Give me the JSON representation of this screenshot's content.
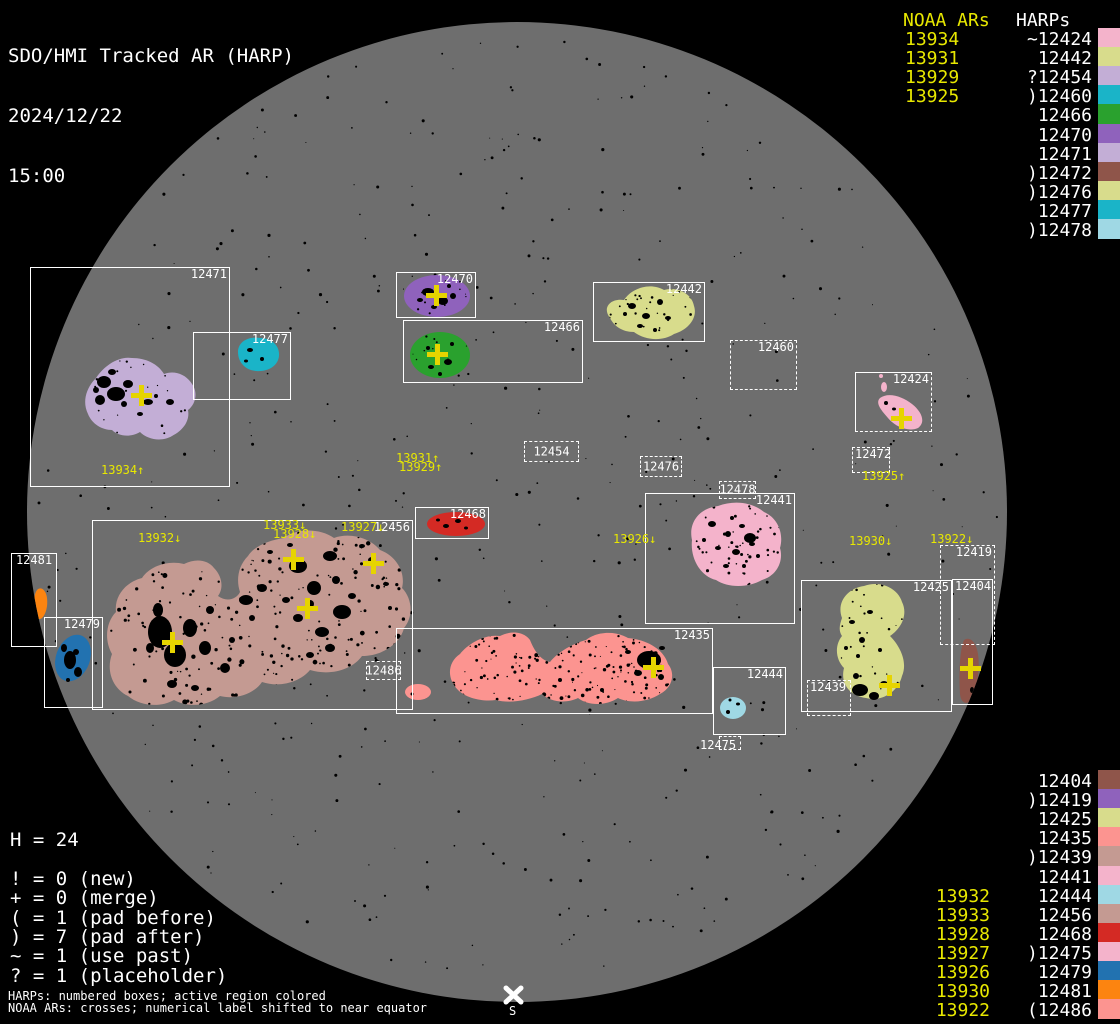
{
  "title": {
    "app": "SDO/HMI Tracked AR (HARP)",
    "date": "2024/12/22",
    "time": "15:00"
  },
  "palette": {
    "background": "#000000",
    "disk": "#6e6e6e",
    "box_line": "#ffffff",
    "text_white": "#ffffff",
    "noaa_yellow": "#e8e800",
    "cross_yellow": "#e6d400"
  },
  "harp_colors": {
    "12404": "#8f554a",
    "12419": "#8f62bc",
    "12424": "#f4b3cb",
    "12425": "#d8dc8c",
    "12435": "#fc9490",
    "12439": "#c49a92",
    "12441": "#f4b3cb",
    "12442": "#d8dc8c",
    "12444": "#9fd8e4",
    "12454": "#c3aed6",
    "12456": "#c49a92",
    "12460": "#1ab4c8",
    "12466": "#2aa12e",
    "12468": "#d42a24",
    "12470": "#8f62bc",
    "12471": "#c3aed6",
    "12472": "#8f554a",
    "12475": "#f4b3cb",
    "12476": "#d8dc8c",
    "12477": "#1ab4c8",
    "12478": "#9fd8e4",
    "12479": "#2272b0",
    "12481": "#fc8410",
    "12486": "#fc9490"
  },
  "top_right": {
    "noaa_header": "NOAA ARs",
    "harps_header": "HARPs",
    "noaa": [
      "13934",
      "13931",
      "13929",
      "13925"
    ],
    "harps": [
      "~12424",
      "12442",
      "?12454",
      ")12460",
      "12466",
      "12470",
      "12471",
      ")12472",
      ")12476",
      "12477",
      ")12478"
    ]
  },
  "bottom_right": {
    "harps": [
      "12404",
      ")12419",
      "12425",
      "12435",
      ")12439",
      "12441",
      "12444",
      "12456",
      "12468",
      ")12475",
      "12479",
      "12481",
      "(12486"
    ],
    "noaa": [
      "13932",
      "13933",
      "13928",
      "13927",
      "13926",
      "13930",
      "13922"
    ],
    "noaa_row_offset": 6
  },
  "legend": {
    "histogram": "H = 24",
    "rows": [
      "! = 0 (new)",
      "+ = 0 (merge)",
      "( = 1 (pad before)",
      ") = 7 (pad after)",
      "~ = 1 (use past)",
      "? = 1 (placeholder)"
    ]
  },
  "footer": {
    "line1": "HARPs: numbered boxes; active region colored",
    "line2": "NOAA ARs: crosses; numerical label shifted to near equator"
  },
  "south_marker": {
    "label": "S"
  },
  "boxes": [
    {
      "label": "12471",
      "x": 30,
      "y": 267,
      "w": 200,
      "h": 220,
      "style": "solid",
      "pos": "tr"
    },
    {
      "label": "12477",
      "x": 193,
      "y": 332,
      "w": 98,
      "h": 68,
      "style": "solid",
      "pos": "tr"
    },
    {
      "label": "12470",
      "x": 396,
      "y": 272,
      "w": 80,
      "h": 46,
      "style": "solid",
      "pos": "tr"
    },
    {
      "label": "12466",
      "x": 403,
      "y": 320,
      "w": 180,
      "h": 63,
      "style": "solid",
      "pos": "tr"
    },
    {
      "label": "12442",
      "x": 593,
      "y": 282,
      "w": 112,
      "h": 60,
      "style": "solid",
      "pos": "tr"
    },
    {
      "label": "12460",
      "x": 730,
      "y": 340,
      "w": 67,
      "h": 50,
      "style": "dotted",
      "pos": "tr"
    },
    {
      "label": "12424",
      "x": 855,
      "y": 372,
      "w": 77,
      "h": 60,
      "style": "mixed",
      "pos": "tr"
    },
    {
      "label": "12472",
      "x": 852,
      "y": 447,
      "w": 38,
      "h": 26,
      "style": "dotted",
      "pos": "tl"
    },
    {
      "label": "12454",
      "x": 524,
      "y": 441,
      "w": 55,
      "h": 21,
      "style": "dotted",
      "pos": "c"
    },
    {
      "label": "12476",
      "x": 640,
      "y": 456,
      "w": 42,
      "h": 21,
      "style": "dotted",
      "pos": "c"
    },
    {
      "label": "12478",
      "x": 719,
      "y": 481,
      "w": 37,
      "h": 18,
      "style": "dotted",
      "pos": "c"
    },
    {
      "label": "12441",
      "x": 645,
      "y": 493,
      "w": 150,
      "h": 131,
      "style": "solid",
      "pos": "tr"
    },
    {
      "label": "12468",
      "x": 415,
      "y": 507,
      "w": 74,
      "h": 32,
      "style": "solid",
      "pos": "tr"
    },
    {
      "label": "12456",
      "x": 92,
      "y": 520,
      "w": 321,
      "h": 190,
      "style": "solid",
      "pos": "tr"
    },
    {
      "label": "12486",
      "x": 366,
      "y": 661,
      "w": 35,
      "h": 19,
      "style": "dotted",
      "pos": "c"
    },
    {
      "label": "12481",
      "x": 11,
      "y": 553,
      "w": 46,
      "h": 94,
      "style": "solid",
      "pos": "tc"
    },
    {
      "label": "12479",
      "x": 44,
      "y": 617,
      "w": 59,
      "h": 91,
      "style": "solid",
      "pos": "tr"
    },
    {
      "label": "12435",
      "x": 396,
      "y": 628,
      "w": 317,
      "h": 86,
      "style": "solid",
      "pos": "tr"
    },
    {
      "label": "12444",
      "x": 713,
      "y": 667,
      "w": 73,
      "h": 68,
      "style": "solid",
      "pos": "tr"
    },
    {
      "label": "",
      "x": 719,
      "y": 736,
      "w": 22,
      "h": 14,
      "style": "dotted",
      "pos": "c"
    },
    {
      "label": "12439",
      "x": 807,
      "y": 680,
      "w": 44,
      "h": 36,
      "style": "dotted",
      "pos": "tl"
    },
    {
      "label": "12425",
      "x": 801,
      "y": 580,
      "w": 151,
      "h": 132,
      "style": "solid",
      "pos": "tr"
    },
    {
      "label": "12404",
      "x": 952,
      "y": 579,
      "w": 41,
      "h": 126,
      "style": "solid",
      "pos": "tl"
    },
    {
      "label": "12419",
      "x": 940,
      "y": 545,
      "w": 55,
      "h": 100,
      "style": "dotted",
      "pos": "tr"
    }
  ],
  "noaa_labels": [
    {
      "text": "13934↑",
      "x": 101,
      "y": 464
    },
    {
      "text": "13931↑",
      "x": 396,
      "y": 452
    },
    {
      "text": "13929↑",
      "x": 399,
      "y": 461
    },
    {
      "text": "13932↓",
      "x": 138,
      "y": 532
    },
    {
      "text": "13933↓",
      "x": 263,
      "y": 519
    },
    {
      "text": "13928↓",
      "x": 273,
      "y": 528
    },
    {
      "text": "13927↓",
      "x": 341,
      "y": 521
    },
    {
      "text": "13926↓",
      "x": 613,
      "y": 533
    },
    {
      "text": "13925↑",
      "x": 862,
      "y": 470
    },
    {
      "text": "13930↓",
      "x": 849,
      "y": 535
    },
    {
      "text": "13922↓",
      "x": 930,
      "y": 533
    }
  ],
  "white_labels": [
    {
      "text": "12475",
      "x": 700,
      "y": 739
    }
  ],
  "crosses": [
    [
      141,
      395
    ],
    [
      436,
      295
    ],
    [
      437,
      354
    ],
    [
      901,
      418
    ],
    [
      293,
      559
    ],
    [
      373,
      563
    ],
    [
      307,
      608
    ],
    [
      172,
      642
    ],
    [
      653,
      667
    ],
    [
      889,
      685
    ],
    [
      970,
      668
    ]
  ]
}
